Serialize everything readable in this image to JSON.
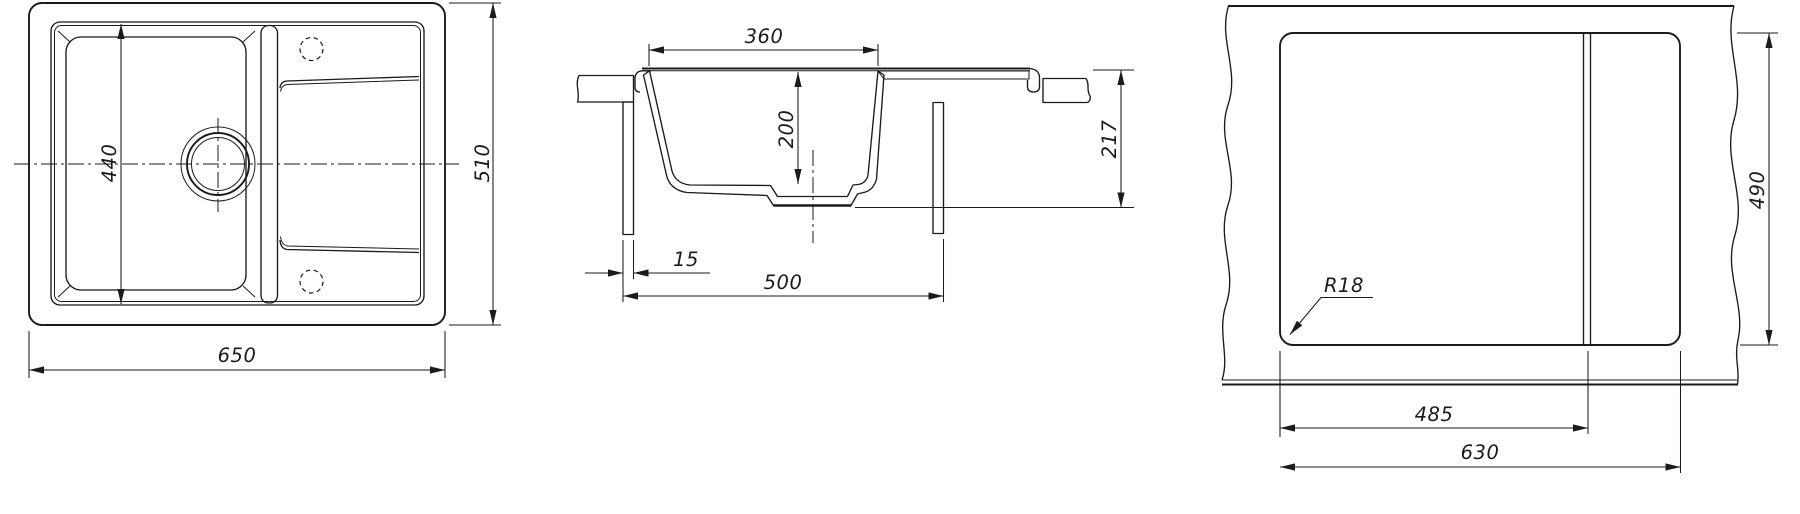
{
  "drawing": {
    "description": "Kitchen sink technical drawing with three views: top view, cross-section view, countertop cutout view",
    "line_color": "#1b1b1b",
    "background_color": "#ffffff"
  },
  "top_view": {
    "bowl_length_mm": "440",
    "overall_width_mm": "650",
    "overall_depth_mm": "510"
  },
  "section_view": {
    "bowl_top_width_mm": "360",
    "bowl_depth_mm": "200",
    "overall_height_mm": "217",
    "panel_offset_mm": "15",
    "cabinet_width_mm": "500"
  },
  "cutout_view": {
    "cutout_depth_mm": "490",
    "corner_radius_label": "R18",
    "bowl_section_cutout_mm": "485",
    "cutout_width_mm": "630"
  }
}
